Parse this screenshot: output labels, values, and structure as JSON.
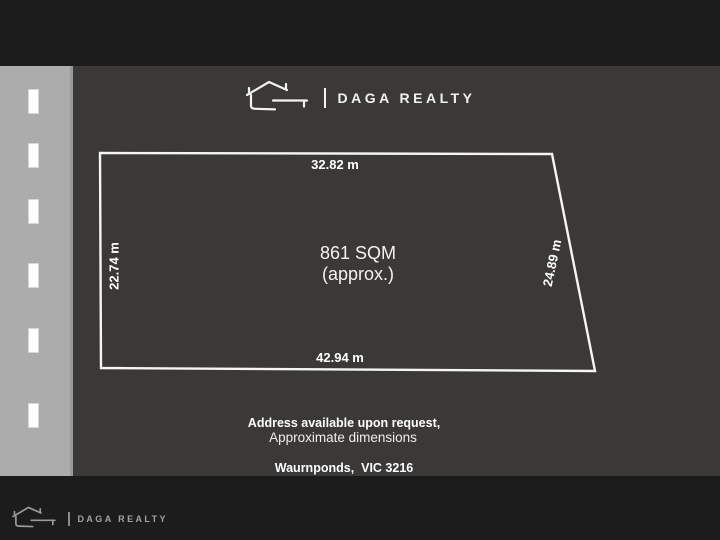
{
  "header_logo": {
    "brand": "DAGA REALTY",
    "icon": "house-logo-icon"
  },
  "lot": {
    "area": "861 SQM",
    "area_note": "(approx.)",
    "dim_top": "32.82 m",
    "dim_bottom": "42.94 m",
    "dim_left": "22.74 m",
    "dim_right": "24.89 m"
  },
  "address": {
    "line1": "Address available upon request,",
    "line2": "Waurnponds,  VIC 3216"
  },
  "note": "Approximate dimensions",
  "footer_logo": {
    "brand": "DAGA REALTY",
    "icon": "house-logo-icon"
  },
  "colors": {
    "band": "#1c1c1c",
    "background": "#3b3938",
    "road": "#acacac",
    "lane_marking": "#ffffff",
    "lot_outline": "#f5f5f5",
    "text": "#ffffff",
    "footer_text": "#a3a3a3"
  }
}
